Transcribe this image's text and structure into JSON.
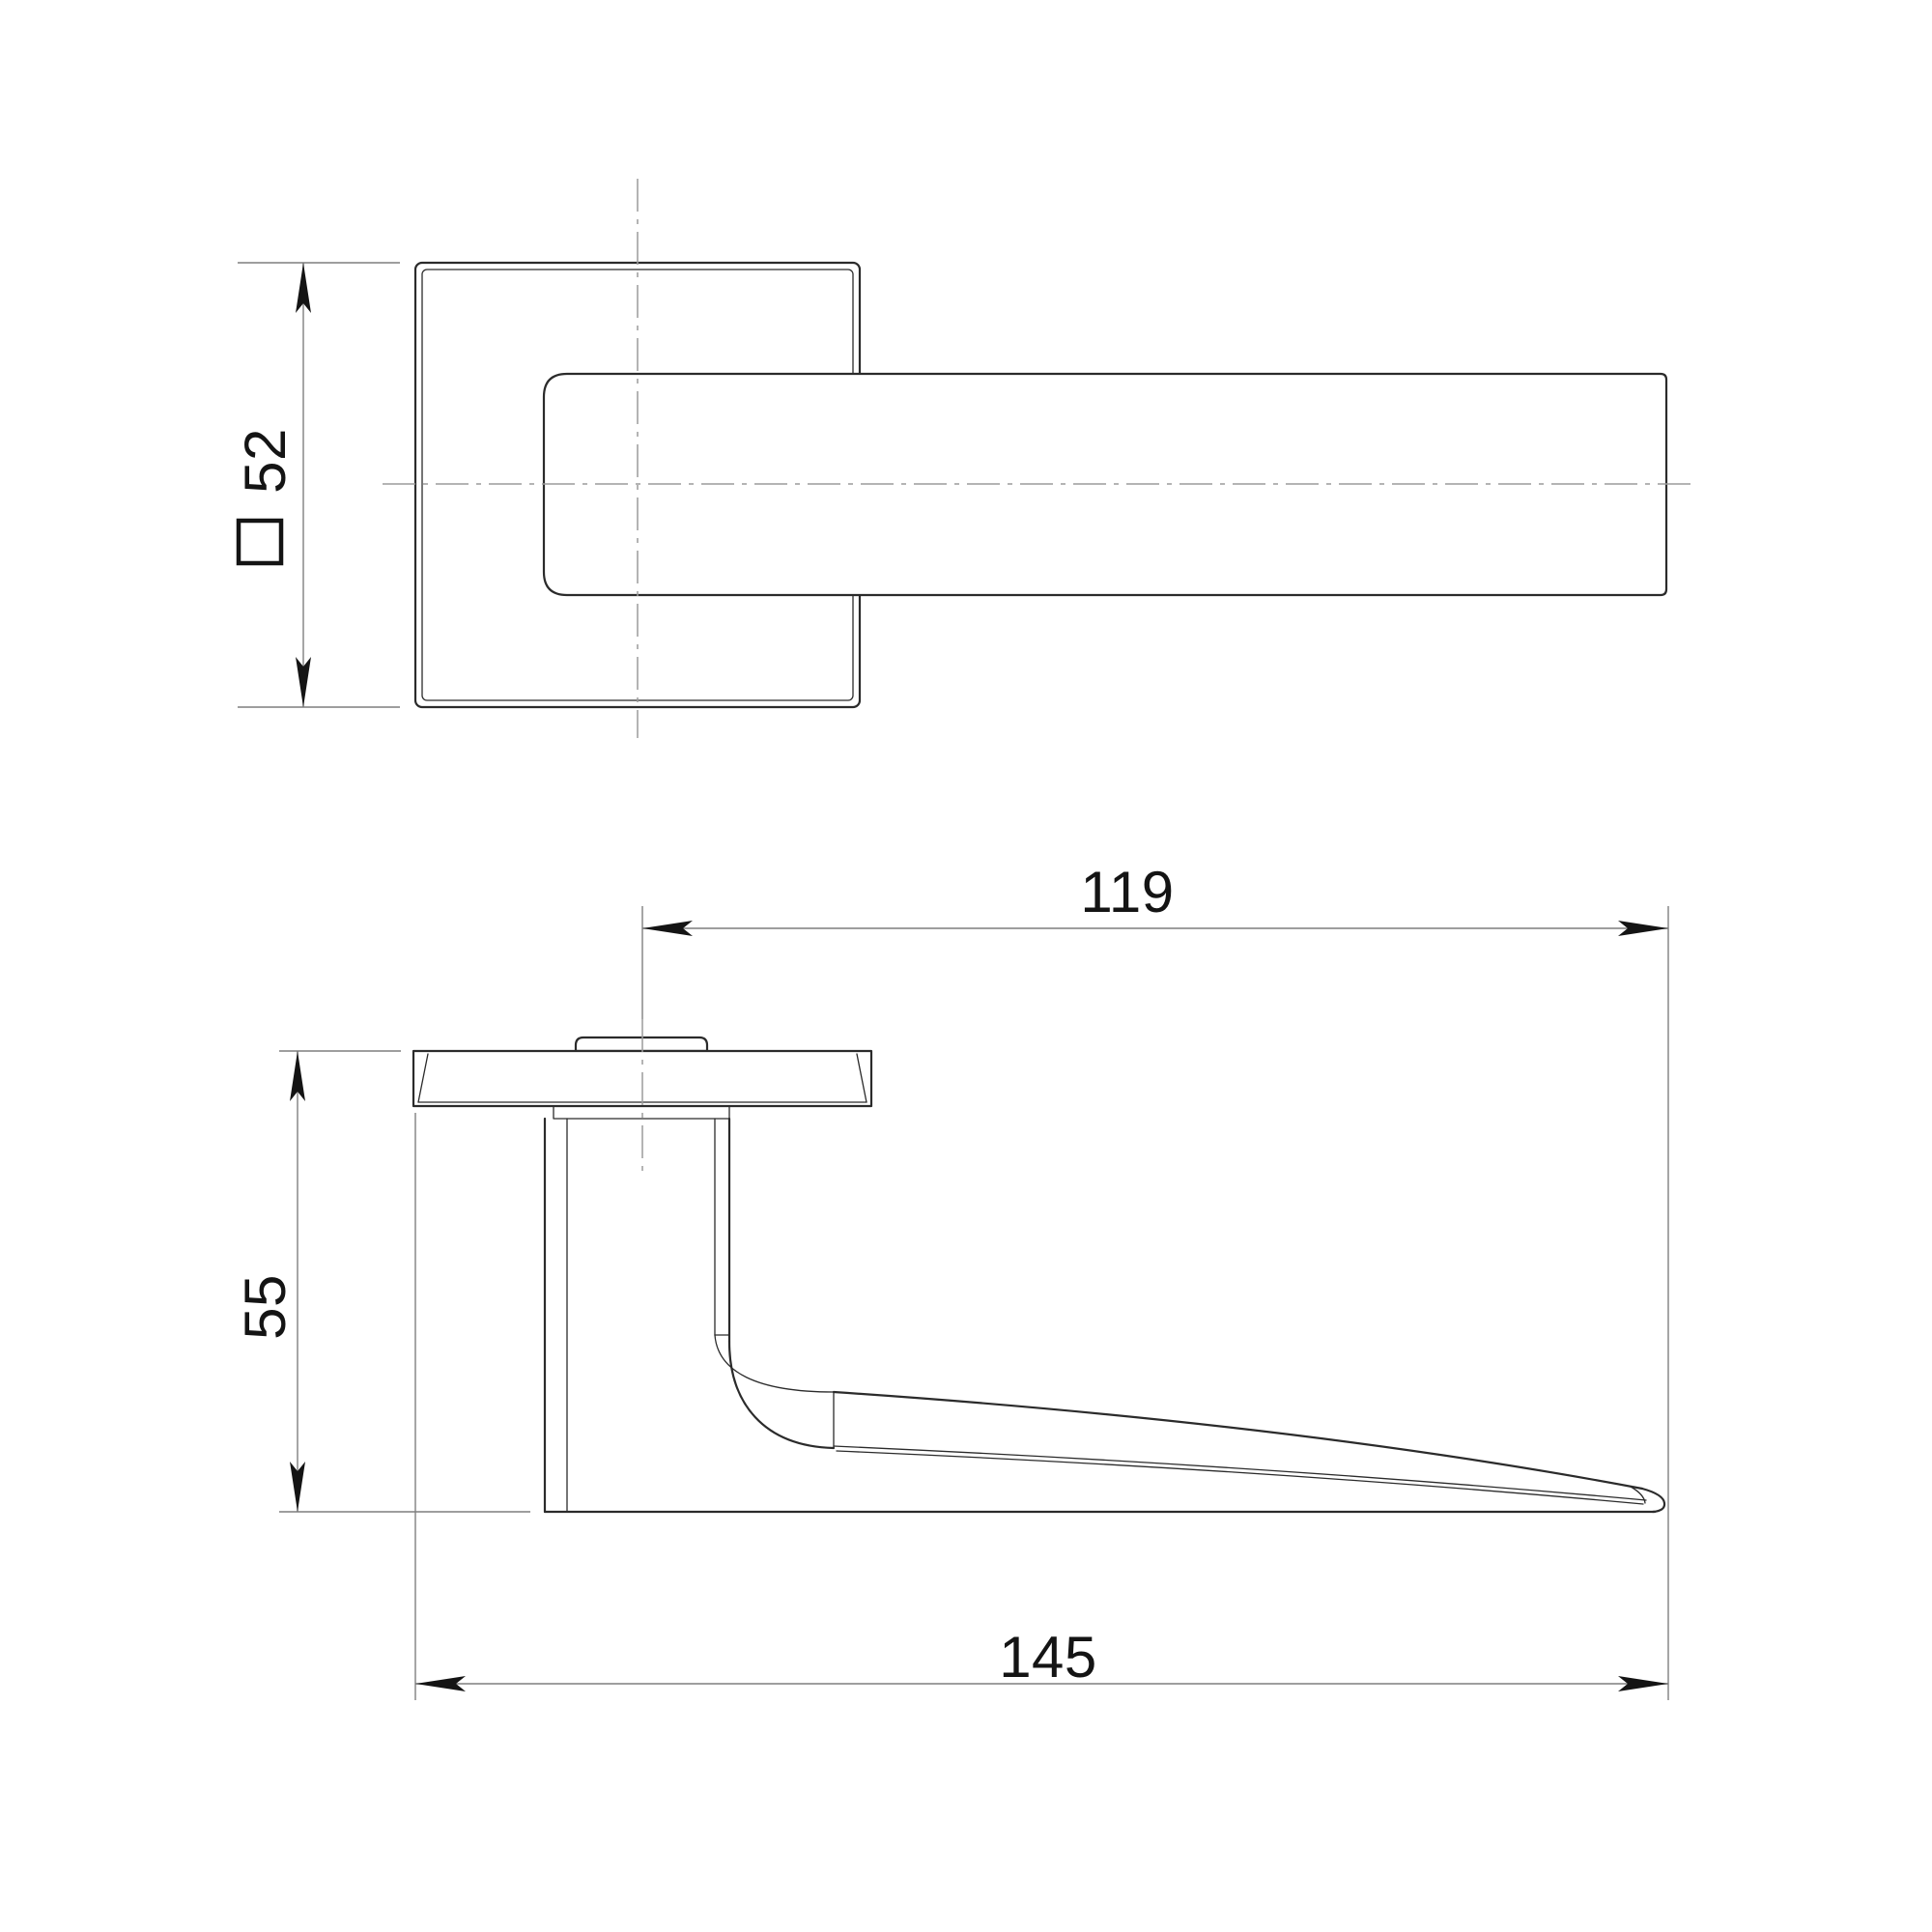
{
  "drawing": {
    "colors": {
      "background": "#ffffff",
      "outline": "#2b2b2b",
      "dimension_lines": "#7f7f7f",
      "centerlines": "#9c9c9c",
      "text": "#141414"
    },
    "dimensions": {
      "rose_size": {
        "symbol": "square-symbol",
        "value": "52"
      },
      "grip_length": {
        "value": "119"
      },
      "projection_height": {
        "value": "55"
      },
      "overall_length": {
        "value": "145"
      }
    }
  }
}
